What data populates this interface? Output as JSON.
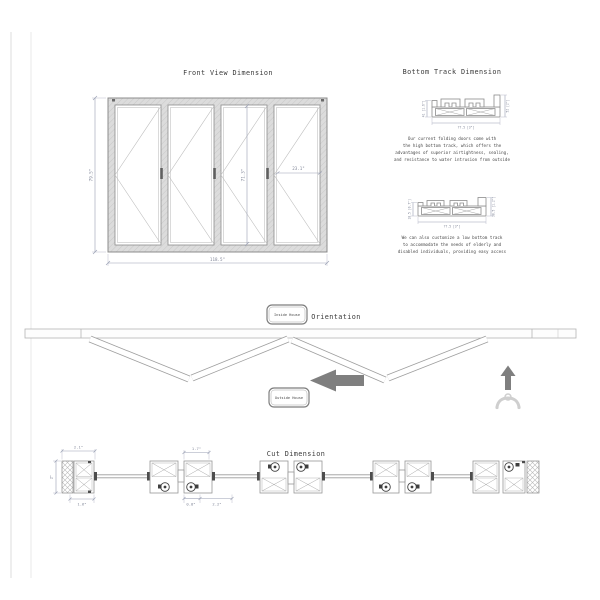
{
  "front_view": {
    "title": "Front View Dimension",
    "overall_height": "79.5\"",
    "overall_width": "118.5\"",
    "panel_height": "71.3\"",
    "panel_width": "23.1\""
  },
  "bottom_track": {
    "title": "Bottom Track Dimension",
    "high_track": {
      "height_left": "41 [1.6\"]",
      "height_right": "52 [2\"]",
      "width_bottom": "77.5 [3\"]",
      "desc_line1": "Our current folding doors come with",
      "desc_line2": "the high bottom track, which offers the",
      "desc_line3": "advantages of superior airtightness, sealing,",
      "desc_line4": "and resistance to water intrusion from outside"
    },
    "low_track": {
      "height_left": "18.5 [0.7\"]",
      "height_right": "30.5 [1.2\"]",
      "width_bottom": "77.5 [3\"]",
      "desc_line1": "We can also customize a low bottom track",
      "desc_line2": "to accommodate the needs of elderly and",
      "desc_line3": "disabled individuals, providing easy access"
    }
  },
  "orientation": {
    "title": "Orientation",
    "inside_label": "Inside House",
    "outside_label": "Outside House"
  },
  "cut_view": {
    "title": "Cut Dimension",
    "dim_top_left": "2.1\"",
    "dim_frame_depth": "2\"",
    "dim_bottom_left": "1.6\"",
    "dim_top_mid": "1.7\"",
    "dim_bottom_mid_small": "0.8\"",
    "dim_bottom_mid_large": "2.2\""
  },
  "colors": {
    "line_gray": "#8c8c8c",
    "dimension_gray": "#9aa0b4",
    "arrow_gray": "#7f7f7f",
    "frame_fill": "#d9d9d9"
  }
}
